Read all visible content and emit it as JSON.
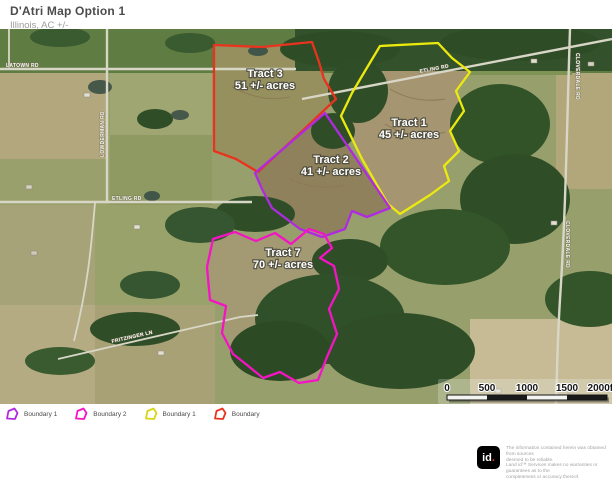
{
  "header": {
    "title": "D'Atri Map Option 1",
    "subtitle": "Illinois,  AC +/-"
  },
  "map": {
    "tracts": [
      {
        "name": "Tract 3",
        "acres": "51 +/- acres",
        "color": "#e8341f"
      },
      {
        "name": "Tract 1",
        "acres": "45 +/- acres",
        "color": "#ece90f"
      },
      {
        "name": "Tract 2",
        "acres": "41 +/- acres",
        "color": "#b02be0"
      },
      {
        "name": "Tract 7",
        "acres": "70 +/- acres",
        "color": "#f414c4"
      }
    ],
    "road_labels": {
      "latown": "LATOWN RD",
      "etling_west": "ETLING RD",
      "etling_east": "ETLING RD",
      "fritzinger": "FRITZINGER LN",
      "cloverdale_1": "CLOVERDALE RD",
      "cloverdale_2": "CLOVERDALE RD",
      "lowderman": "LOWDERMAN RD"
    }
  },
  "scalebar": {
    "t0": "0",
    "t1": "500",
    "t2": "1000",
    "t3": "1500",
    "t4": "2000ft"
  },
  "legend": {
    "items": [
      {
        "label": "Boundary 1",
        "color": "#b02be0"
      },
      {
        "label": "Boundary 2",
        "color": "#f414c4"
      },
      {
        "label": "Boundary 1",
        "color": "#d9d513"
      },
      {
        "label": "Boundary",
        "color": "#e8341f"
      }
    ]
  },
  "footer": {
    "logo_text": "id",
    "logo_dot": ".",
    "disclaimer": [
      "The information contained herein was obtained from sources",
      "deemed to be reliable.",
      "Land id™ Services makes no warranties or guarantees as to the",
      "completeness or accuracy thereof."
    ]
  }
}
